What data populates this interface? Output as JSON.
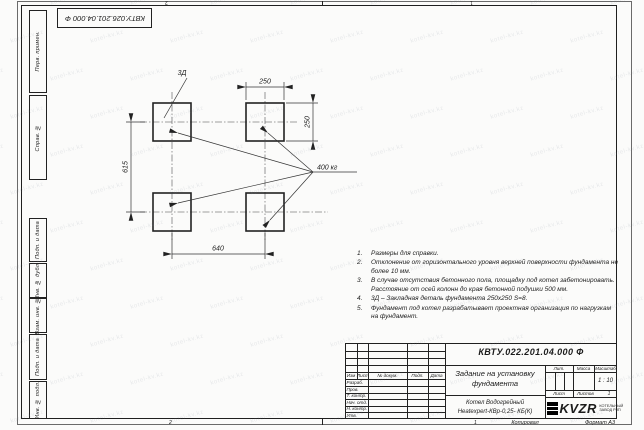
{
  "watermark": {
    "text": "kotel-kv.kz"
  },
  "top_designation": "КВТУ.026.201.04.000 Ф",
  "margin_labels": {
    "perv": "Перв. примен.",
    "sprav": "Справ. №",
    "podp1": "Подп. и дата",
    "inv_dubl": "Инв. № дубл.",
    "vzam": "Взам. инв. №",
    "podp2": "Подп. и дата",
    "inv_podl": "Инв. № подл."
  },
  "drawing": {
    "embed_label": "3Д",
    "dim_top": "250",
    "dim_right": "250",
    "dim_left": "615",
    "dim_bottom": "640",
    "load_label": "400 кг"
  },
  "notes": [
    {
      "num": "1.",
      "text": "Размеры для справки."
    },
    {
      "num": "2.",
      "text": "Отклонение от горизонтального уровня верхней поверхности фундамента не более 10 мм."
    },
    {
      "num": "3.",
      "text": "В случае отсутствия бетонного пола, площадку под котел забетонировать. Расстояние от осей колонн до края бетонной подушки 500 мм."
    },
    {
      "num": "4.",
      "text": "3Д – Закладная деталь фундамента 250x250 S=8."
    },
    {
      "num": "5.",
      "text": "Фундамент под котел разрабатывает проектная организация по нагрузкам на фундамент."
    }
  ],
  "title_block": {
    "designation": "КВТУ.022.201.04.000 Ф",
    "doc_title": "Задание на установку фундамента",
    "product": "Котел Водогрейный",
    "product2": "Heatexpert-КВр-0,25- КБ(К)",
    "cols": [
      "Изм",
      "Лист",
      "№ докум.",
      "Подп.",
      "Дата"
    ],
    "rows": [
      "Разраб.",
      "Пров.",
      "Т. контр.",
      "Нач. отд.",
      "Н. контр.",
      "Утв."
    ],
    "lit_label": "Лит.",
    "mass_label": "Масса",
    "scale_label": "Масштаб",
    "scale_value": "1 : 10",
    "sheet_label": "Лист",
    "sheets_label": "Листов",
    "sheets_value": "1",
    "logo_text": "KVZR",
    "logo_sub1": "КОТЕЛЬНЫЙ",
    "logo_sub2": "ЗАВОД РЗП"
  },
  "footer": {
    "zone_left": "2",
    "zone_right": "1",
    "copied": "Копировал",
    "format": "Формат А3"
  }
}
